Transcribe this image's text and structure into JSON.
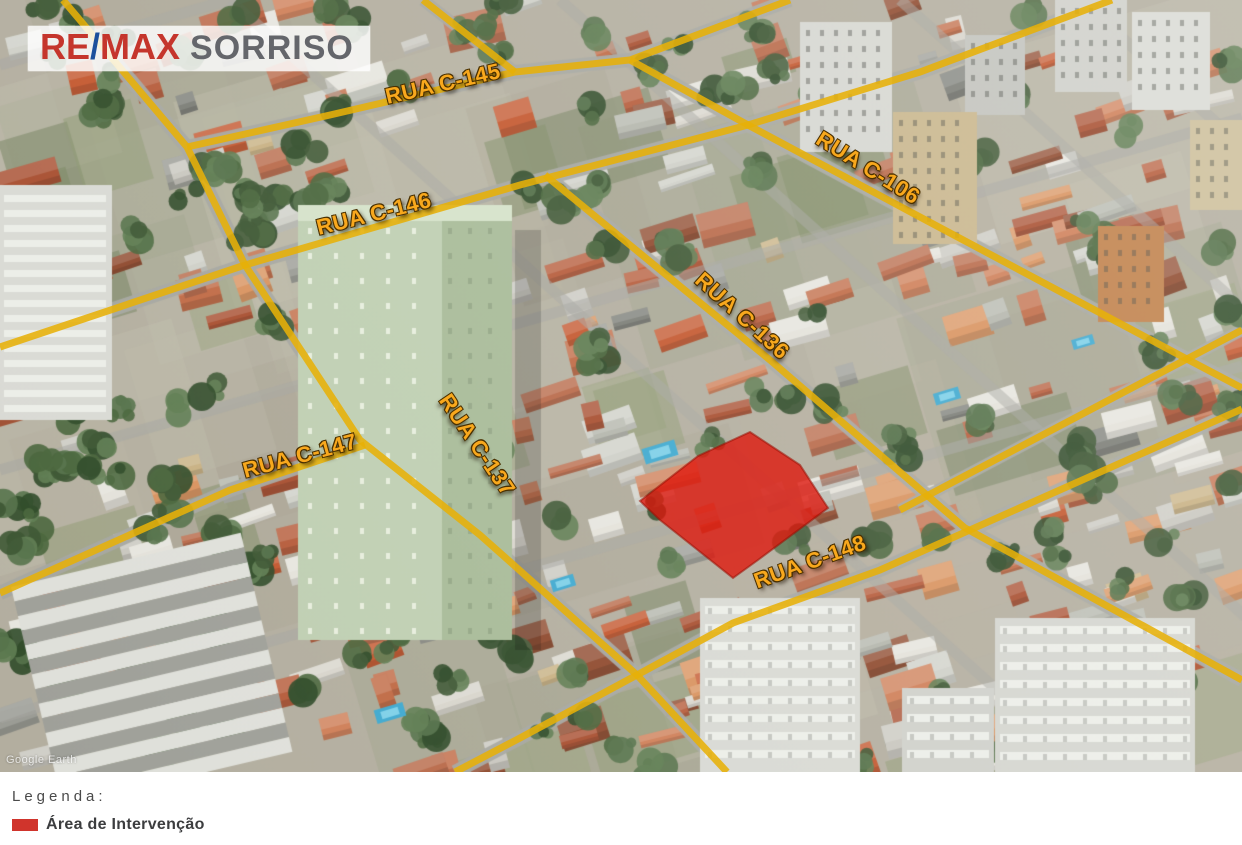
{
  "logo": {
    "re": "RE",
    "slash": "/",
    "max": "MAX",
    "name": "SORRISO"
  },
  "map": {
    "watermark": "Google Earth",
    "streets": [
      {
        "name": "RUA C-145",
        "label_x": 443,
        "label_y": 84,
        "label_rotation": -13,
        "line": [
          [
            187,
            147
          ],
          [
            330,
            115
          ],
          [
            515,
            72
          ],
          [
            630,
            60
          ],
          [
            790,
            0
          ]
        ]
      },
      {
        "name": "RUA C-146",
        "label_x": 374,
        "label_y": 214,
        "label_rotation": -14,
        "line": [
          [
            0,
            347
          ],
          [
            245,
            265
          ],
          [
            520,
            185
          ],
          [
            748,
            125
          ],
          [
            920,
            72
          ],
          [
            1112,
            0
          ]
        ]
      },
      {
        "name": "RUA C-106",
        "label_x": 868,
        "label_y": 168,
        "label_rotation": 32,
        "line": [
          [
            630,
            60
          ],
          [
            748,
            125
          ],
          [
            920,
            217
          ],
          [
            1183,
            357
          ],
          [
            1242,
            388
          ]
        ]
      },
      {
        "name": "RUA C-136",
        "label_x": 742,
        "label_y": 316,
        "label_rotation": 42,
        "line": [
          [
            545,
            175
          ],
          [
            670,
            278
          ],
          [
            770,
            360
          ],
          [
            965,
            528
          ],
          [
            1242,
            680
          ]
        ]
      },
      {
        "name": "RUA C-147",
        "label_x": 300,
        "label_y": 456,
        "label_rotation": -15,
        "line": [
          [
            0,
            593
          ],
          [
            230,
            490
          ],
          [
            365,
            445
          ]
        ]
      },
      {
        "name": "RUA C-137",
        "label_x": 477,
        "label_y": 445,
        "label_rotation": 56,
        "line": [
          [
            63,
            0
          ],
          [
            187,
            147
          ],
          [
            245,
            265
          ],
          [
            360,
            440
          ],
          [
            480,
            535
          ],
          [
            637,
            675
          ],
          [
            727,
            772
          ]
        ]
      },
      {
        "name": "RUA C-148",
        "label_x": 810,
        "label_y": 562,
        "label_rotation": -20,
        "line": [
          [
            455,
            772
          ],
          [
            520,
            738
          ],
          [
            637,
            675
          ],
          [
            733,
            623
          ],
          [
            880,
            570
          ],
          [
            1242,
            409
          ]
        ]
      }
    ],
    "unnamed_segments": [
      [
        [
          423,
          0
        ],
        [
          515,
          72
        ]
      ],
      [
        [
          900,
          510
        ],
        [
          1242,
          330
        ]
      ]
    ],
    "intervention_area": {
      "polygon": [
        [
          750,
          432
        ],
        [
          800,
          465
        ],
        [
          828,
          508
        ],
        [
          758,
          560
        ],
        [
          733,
          578
        ],
        [
          660,
          520
        ],
        [
          640,
          501
        ],
        [
          698,
          456
        ]
      ],
      "fill": "#df140a",
      "opacity": 0.78
    }
  },
  "legend": {
    "title": "Legenda:",
    "items": [
      {
        "swatch_color": "#d0342c",
        "label": "Área de Intervenção"
      }
    ]
  },
  "colors": {
    "street_line": "#e7b008",
    "street_label": "#f8a81d",
    "remax_red": "#c5352c",
    "remax_blue": "#1c4f9c",
    "sorriso_gray": "#64666b"
  }
}
